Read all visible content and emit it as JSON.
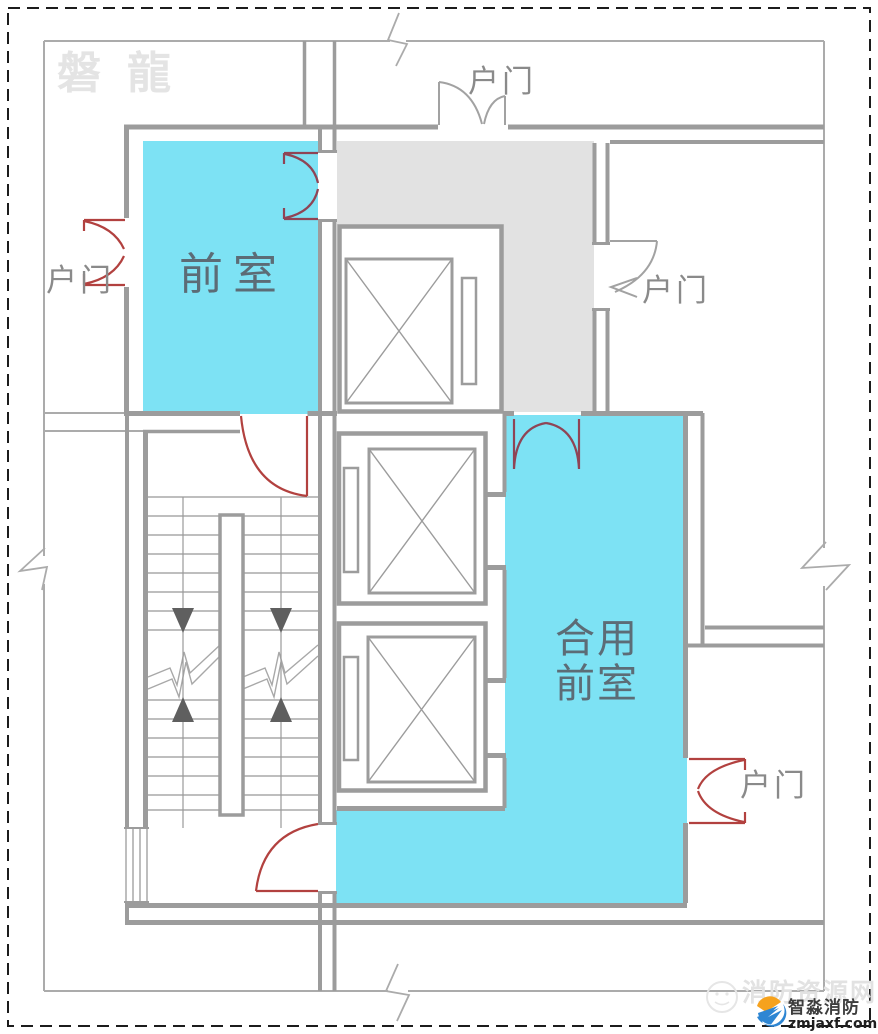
{
  "watermarks": {
    "brand": "磐龍",
    "site": "消防资源网"
  },
  "rooms": {
    "front_room": {
      "label": "前室",
      "fill": "#7de2f4"
    },
    "shared_front_room": {
      "label_line1": "合用",
      "label_line2": "前室",
      "fill": "#7de2f4"
    },
    "corridor": {
      "fill": "#e2e2e2"
    }
  },
  "doors": {
    "top": {
      "label": "户门"
    },
    "left": {
      "label": "户门"
    },
    "right": {
      "label": "户门"
    },
    "bottom_right": {
      "label": "户门"
    }
  },
  "logo": {
    "company": "智淼消防",
    "domain": "zmjaxf.com"
  },
  "palette": {
    "wall": "#9c9c9c",
    "outer_wall": "#ababab",
    "door_red": "#b2413f",
    "door_maroon": "#8f4455",
    "label_dark": "#5c6c76",
    "label_gray": "#8a8a8a"
  }
}
